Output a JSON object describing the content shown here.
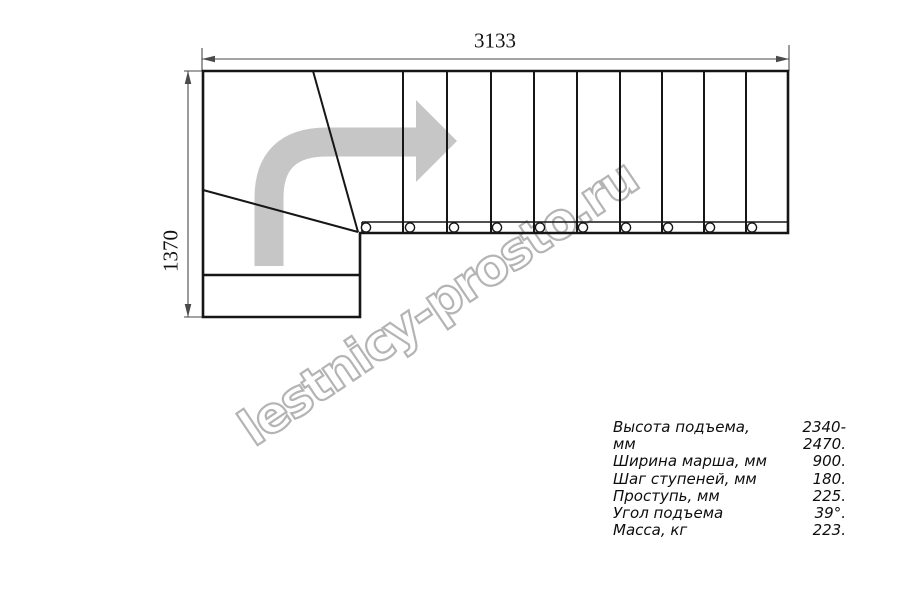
{
  "watermark": {
    "text": "lestnicy-prosto.ru"
  },
  "dimensions": {
    "width_label": "3133",
    "depth_label": "1370"
  },
  "specs": {
    "rows": [
      {
        "label": "Высота подъема, мм",
        "value": "2340-2470."
      },
      {
        "label": "Ширина марша, мм",
        "value": "900."
      },
      {
        "label": "Шаг ступеней, мм",
        "value": "180."
      },
      {
        "label": "Проступь, мм",
        "value": "225."
      },
      {
        "label": "Угол подъема",
        "value": "39°."
      },
      {
        "label": "Масса, кг",
        "value": "223."
      }
    ]
  },
  "plan": {
    "straight_flight_tread_line_xs": [
      403,
      447,
      491,
      534,
      577,
      620,
      662,
      704,
      746
    ],
    "mount_circle_xs": [
      366,
      410,
      454,
      497,
      540,
      583,
      626,
      668,
      710,
      752
    ],
    "straight_steps": 10,
    "winder_steps": 3
  },
  "colors": {
    "line": "#161616",
    "dimension": "#4a4a4a",
    "direction_arrow": "#c6c6c6",
    "watermark_outline": "#b4b4b4"
  }
}
